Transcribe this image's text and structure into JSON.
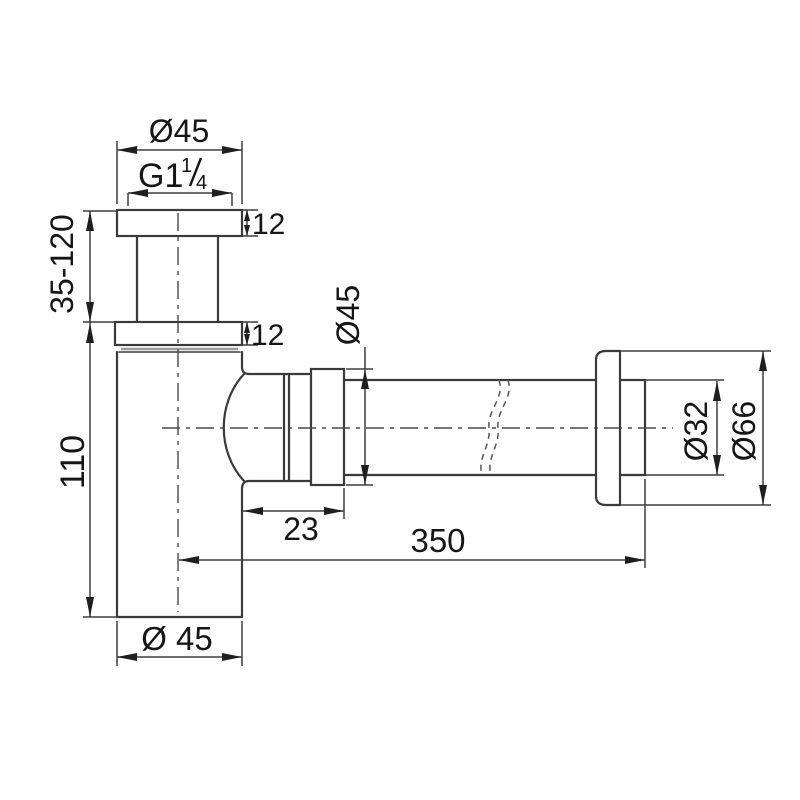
{
  "drawing": {
    "type": "technical-dimension-drawing",
    "subject": "bottle-trap-siphon-side-view",
    "colors": {
      "background": "#ffffff",
      "part_line": "#3a3a3a",
      "dimension_line": "#3f3f3f",
      "text": "#161616"
    },
    "labels": {
      "top_flange_diameter": "Ø45",
      "thread_prefix": "G1",
      "thread_frac_numerator": "1",
      "thread_frac_denominator": "4",
      "top_flange_thickness": "12",
      "lower_flange_thickness": "12",
      "inlet_adjust_range": "35-120",
      "body_height": "110",
      "body_diameter": "Ø 45",
      "outlet_nut_diameter": "Ø45",
      "outlet_offset": "23",
      "outlet_pipe_length": "350",
      "outlet_pipe_diameter": "Ø32",
      "wall_flange_diameter": "Ø66"
    }
  }
}
